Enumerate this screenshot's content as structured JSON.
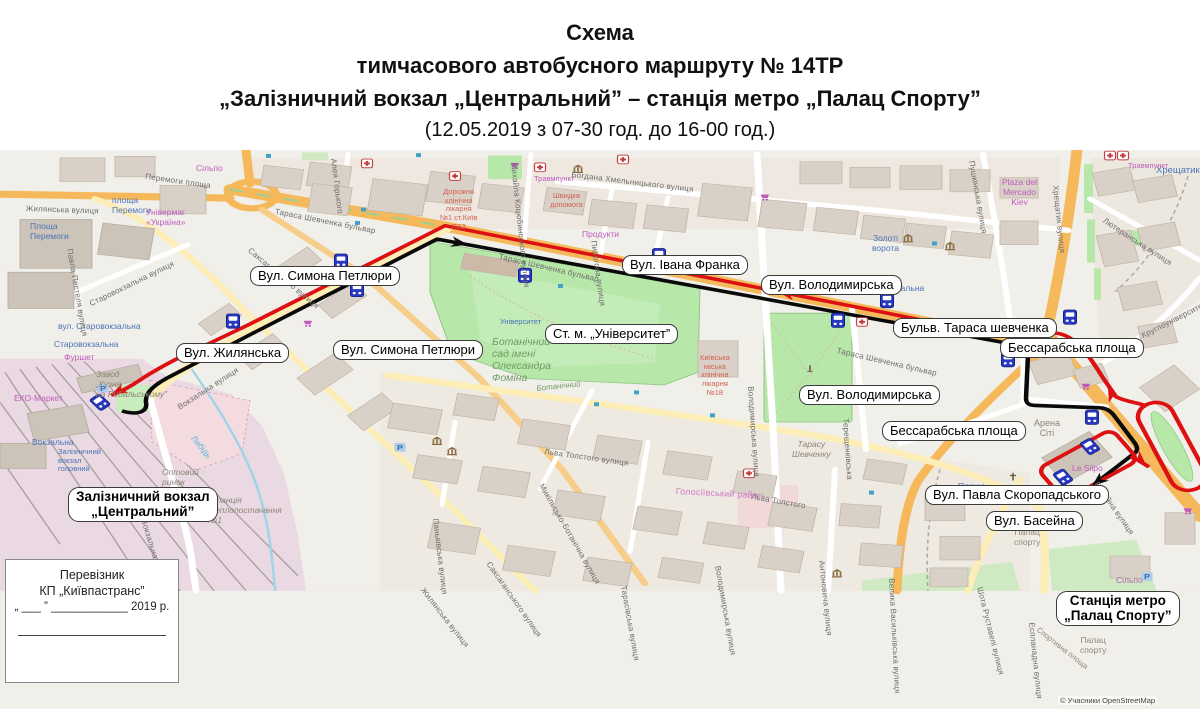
{
  "title": {
    "line1": "Схема",
    "line2": "тимчасового автобусного маршруту  № 14ТР",
    "line3": "„Залізничний вокзал „Центральний” – станція метро „Палац Спорту”",
    "line4": "(12.05.2019 з 07-30 год. до 16-00 год.)"
  },
  "carrier_box": {
    "line1": "Перевізник",
    "line2": "КП „Київпастранс”",
    "line3": "„ ___ ”  ____________ 2019 р."
  },
  "map": {
    "attribution": "© Учасники OpenStreetMap",
    "route": {
      "outbound": "#0a0a0a",
      "return": "#dd1111"
    },
    "icons": {
      "bus_stop_color": "#2838c0",
      "bus_stop_icon": "bus-stop-icon",
      "hospital_icon": "hospital-cross-icon",
      "museum_icon": "museum-icon",
      "parking_icon": "parking-icon",
      "church_icon": "church-cross-icon",
      "synagogue_icon": "star-of-david-icon",
      "shop_icon": "shopping-cart-icon",
      "monument_icon": "monument-icon"
    },
    "callouts": [
      {
        "lines": [
          "Вул. Симона Петлюри"
        ],
        "x": 250,
        "y": 266
      },
      {
        "lines": [
          "Вул. Жилянська"
        ],
        "x": 176,
        "y": 343
      },
      {
        "lines": [
          "Вул. Симона Петлюри"
        ],
        "x": 333,
        "y": 340
      },
      {
        "lines": [
          "Ст. м. „Університет”"
        ],
        "x": 545,
        "y": 324
      },
      {
        "lines": [
          "Вул. Івана Франка"
        ],
        "x": 622,
        "y": 255
      },
      {
        "lines": [
          "Вул. Володимирська"
        ],
        "x": 761,
        "y": 275
      },
      {
        "lines": [
          "Бульв. Тараса шевченка"
        ],
        "x": 893,
        "y": 318
      },
      {
        "lines": [
          "Бессарабська площа"
        ],
        "x": 1000,
        "y": 338
      },
      {
        "lines": [
          "Вул. Володимирська"
        ],
        "x": 799,
        "y": 385
      },
      {
        "lines": [
          "Бессарабська площа"
        ],
        "x": 882,
        "y": 421
      },
      {
        "lines": [
          "Вул. Павла Скоропадського"
        ],
        "x": 925,
        "y": 485
      },
      {
        "lines": [
          "Вул. Басейна"
        ],
        "x": 986,
        "y": 511
      },
      {
        "lines": [
          "Залізничний вокзал",
          "„Центральний”"
        ],
        "x": 68,
        "y": 487,
        "bold": true
      },
      {
        "lines": [
          "Станція метро",
          "„Палац Спорту”"
        ],
        "x": 1056,
        "y": 591,
        "bold": true
      }
    ],
    "street_labels": [
      {
        "t": "Жилянська вулиця",
        "x": 26,
        "y": 204,
        "r": 2
      },
      {
        "t": "Перемоги площа",
        "x": 146,
        "y": 172,
        "r": 8
      },
      {
        "t": "Тараса Шевченка бульвар",
        "x": 276,
        "y": 207,
        "r": 11
      },
      {
        "t": "Тараса Шевченка бульвар",
        "x": 500,
        "y": 252,
        "r": 13
      },
      {
        "t": "Тараса Шевченка бульвар",
        "x": 838,
        "y": 346,
        "r": 13
      },
      {
        "t": "Богдана Хмельницького вулиця",
        "x": 572,
        "y": 170,
        "r": 7
      },
      {
        "t": "Алея Горького",
        "x": 338,
        "y": 158,
        "r": 83
      },
      {
        "t": "Михайла Коцюбинського вулиця",
        "x": 518,
        "y": 162,
        "r": 84
      },
      {
        "t": "Пирогова вулиця",
        "x": 598,
        "y": 240,
        "r": 82
      },
      {
        "t": "Пушкінська вулиця",
        "x": 976,
        "y": 160,
        "r": 80
      },
      {
        "t": "Хрещатик вулиця",
        "x": 1060,
        "y": 185,
        "r": 84
      },
      {
        "t": "Лютеранська вулиця",
        "x": 1106,
        "y": 216,
        "r": 33
      },
      {
        "t": "Круглоуніверситетська",
        "x": 1140,
        "y": 332,
        "r": -27
      },
      {
        "t": "Саксаганського вулиця",
        "x": 252,
        "y": 246,
        "r": 40
      },
      {
        "t": "Саксаганського вулиця",
        "x": 492,
        "y": 560,
        "r": 55
      },
      {
        "t": "Старовокзальна вулиця",
        "x": 88,
        "y": 300,
        "r": -26
      },
      {
        "t": "Павла Пестеля вулиця",
        "x": 74,
        "y": 248,
        "r": 80
      },
      {
        "t": "Вокзальна вулиця",
        "x": 176,
        "y": 404,
        "r": -33
      },
      {
        "t": "Вокзальна вулиця",
        "x": 148,
        "y": 518,
        "r": 73
      },
      {
        "t": "Жилянська вулиця",
        "x": 426,
        "y": 586,
        "r": 52
      },
      {
        "t": "Льва Толстого вулиця",
        "x": 545,
        "y": 447,
        "r": 8
      },
      {
        "t": "Льва Толстого",
        "x": 752,
        "y": 492,
        "r": 10
      },
      {
        "t": "Паньківська вулиця",
        "x": 440,
        "y": 518,
        "r": 83
      },
      {
        "t": "Микільсько-Ботанічна вулиця",
        "x": 545,
        "y": 482,
        "r": 60
      },
      {
        "t": "Тарасівська вулиця",
        "x": 628,
        "y": 585,
        "r": 80
      },
      {
        "t": "Володимирська вулиця",
        "x": 755,
        "y": 386,
        "r": 86
      },
      {
        "t": "Володимирська вулиця",
        "x": 722,
        "y": 565,
        "r": 80
      },
      {
        "t": "Терещенківська",
        "x": 850,
        "y": 418,
        "r": 86
      },
      {
        "t": "Басейна вулиця",
        "x": 1100,
        "y": 480,
        "r": 55
      },
      {
        "t": "Еспланадна вулиця",
        "x": 1036,
        "y": 622,
        "r": 84
      },
      {
        "t": "Шота Руставелі вулиця",
        "x": 984,
        "y": 586,
        "r": 76
      },
      {
        "t": "Велика Васильківська вулиця",
        "x": 896,
        "y": 578,
        "r": 87
      },
      {
        "t": "Антоновича вулиця",
        "x": 826,
        "y": 560,
        "r": 84
      },
      {
        "t": "Голосіївський район",
        "x": 676,
        "y": 486,
        "r": 3,
        "c": "#cf7ac9",
        "s": 9
      }
    ],
    "place_labels": [
      {
        "t": "площа\nПеремоги",
        "x": 112,
        "y": 196,
        "c": "blue"
      },
      {
        "t": "Площа\nПеремоги",
        "x": 30,
        "y": 222,
        "c": "blue"
      },
      {
        "t": "Універмаг\n«Україна»",
        "x": 146,
        "y": 208,
        "c": "magenta"
      },
      {
        "t": "Сільпо",
        "x": 196,
        "y": 164,
        "c": "magenta"
      },
      {
        "t": "вул. Старовокзальна",
        "x": 58,
        "y": 322,
        "c": "blue"
      },
      {
        "t": "Старовокзальна",
        "x": 54,
        "y": 340,
        "c": "blue"
      },
      {
        "t": "Фуршет",
        "x": 64,
        "y": 353,
        "c": "magenta"
      },
      {
        "t": "Завод\n„Кузня\nна Рибальському”",
        "x": 96,
        "y": 370,
        "c": "gray",
        "i": true
      },
      {
        "t": "ЕКО-Маркет",
        "x": 14,
        "y": 394,
        "c": "magenta"
      },
      {
        "t": "Вокзальна",
        "x": 32,
        "y": 438,
        "c": "blue"
      },
      {
        "t": "Залізничний\nвокзал\nголовний",
        "x": 58,
        "y": 448,
        "c": "blue",
        "s": 7.5
      },
      {
        "t": "Київ-Пасажирський",
        "x": 84,
        "y": 508,
        "c": "blue",
        "s": 10
      },
      {
        "t": "Оптовий\nринок",
        "x": 162,
        "y": 468,
        "c": "gray",
        "i": true
      },
      {
        "t": "Станція\nтеплопостачання\n№1",
        "x": 208,
        "y": 496,
        "c": "gray",
        "i": true
      },
      {
        "t": "Либідь",
        "x": 196,
        "y": 434,
        "c": "cyan",
        "r": 50
      },
      {
        "t": "Ботанічний\nсад імені\nОлександра\nФоміна",
        "x": 492,
        "y": 336,
        "c": "green",
        "i": true,
        "s": 10.5
      },
      {
        "t": "Ботанічний",
        "x": 536,
        "y": 384,
        "c": "green",
        "i": true,
        "r": -6,
        "s": 8
      },
      {
        "t": "Університет",
        "x": 500,
        "y": 318,
        "c": "blue",
        "s": 7.5
      },
      {
        "t": "Київська\nміська\nклінічна\nлікарня\n№18",
        "x": 700,
        "y": 354,
        "c": "red",
        "s": 7.5,
        "ctr": true
      },
      {
        "t": "Тарасу\nШевченку",
        "x": 792,
        "y": 440,
        "c": "gray",
        "i": true,
        "ctr": true
      },
      {
        "t": "Театральна",
        "x": 878,
        "y": 284,
        "c": "blue"
      },
      {
        "t": "Золоті\nворота",
        "x": 872,
        "y": 234,
        "c": "blue",
        "ctr": true
      },
      {
        "t": "Хрещатик",
        "x": 1156,
        "y": 166,
        "c": "blue",
        "s": 9.5
      },
      {
        "t": "Plaza del\nMercado\nKiev",
        "x": 1002,
        "y": 178,
        "c": "magenta",
        "ctr": true
      },
      {
        "t": "Травмпункт",
        "x": 534,
        "y": 175,
        "c": "magenta",
        "s": 7.5
      },
      {
        "t": "Травмпункт",
        "x": 1128,
        "y": 162,
        "c": "magenta",
        "s": 7.5
      },
      {
        "t": "Дорожня\nклінічна\nлікарня\n№1 ст.Київ\nПЗЗ",
        "x": 440,
        "y": 188,
        "c": "red",
        "ctr": true,
        "s": 7.5
      },
      {
        "t": "Швидка\nдопомога",
        "x": 550,
        "y": 192,
        "c": "red",
        "ctr": true,
        "s": 7.5
      },
      {
        "t": "Продукти",
        "x": 582,
        "y": 230,
        "c": "magenta"
      },
      {
        "t": "Арена\nСіті",
        "x": 1034,
        "y": 418,
        "c": "gray",
        "ctr": true,
        "s": 9
      },
      {
        "t": "Le Silpo",
        "x": 1072,
        "y": 464,
        "c": "magenta"
      },
      {
        "t": "Сільпо",
        "x": 1116,
        "y": 576,
        "c": "magenta"
      },
      {
        "t": "Площа",
        "x": 958,
        "y": 482,
        "c": "blue"
      },
      {
        "t": "Палац\nспорту",
        "x": 1014,
        "y": 528,
        "c": "gray",
        "ctr": true
      },
      {
        "t": "Палац\nспорту",
        "x": 1080,
        "y": 636,
        "c": "gray",
        "ctr": true
      },
      {
        "t": "Спортивна площа",
        "x": 1040,
        "y": 626,
        "c": "gray",
        "r": 38,
        "s": 7.5
      }
    ],
    "bus_stops": [
      {
        "x": 100,
        "y": 470,
        "r": -40
      },
      {
        "x": 233,
        "y": 367,
        "r": 0
      },
      {
        "x": 341,
        "y": 291,
        "r": 0
      },
      {
        "x": 357,
        "y": 327,
        "r": 0
      },
      {
        "x": 525,
        "y": 309,
        "r": 0
      },
      {
        "x": 659,
        "y": 284,
        "r": 0
      },
      {
        "x": 838,
        "y": 366,
        "r": 0
      },
      {
        "x": 887,
        "y": 341,
        "r": 0
      },
      {
        "x": 1008,
        "y": 416,
        "r": 0
      },
      {
        "x": 1070,
        "y": 362,
        "r": 0
      },
      {
        "x": 1092,
        "y": 489,
        "r": 0
      },
      {
        "x": 1090,
        "y": 526,
        "r": -35
      },
      {
        "x": 1063,
        "y": 565,
        "r": -35
      }
    ]
  }
}
